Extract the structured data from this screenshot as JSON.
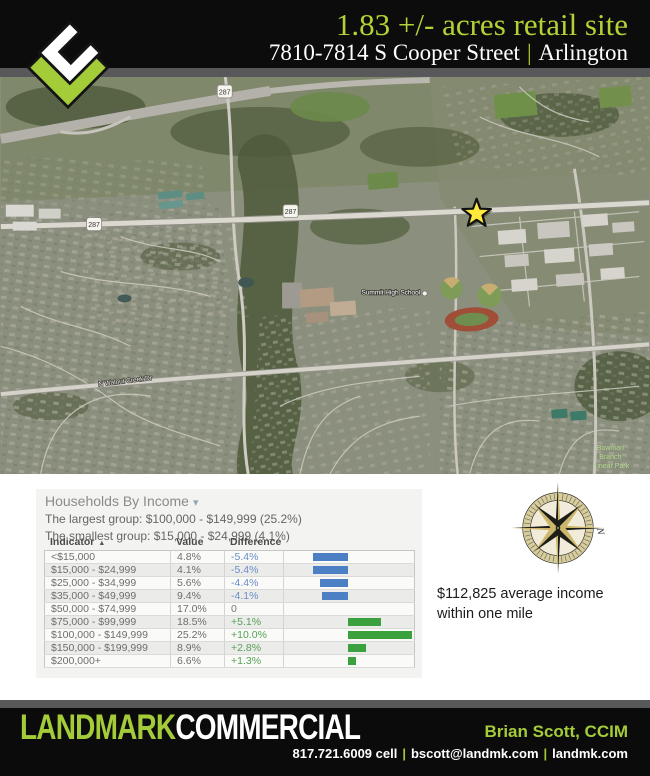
{
  "header": {
    "title": "1.83 +/- acres retail site",
    "address": "7810-7814 S Cooper Street",
    "separator": "|",
    "city": "Arlington"
  },
  "map": {
    "labels": {
      "route_shield": "287",
      "school": "Summit High School",
      "road": "N Walnut Creek Dr",
      "park_line1": "Bowman",
      "park_line2": "Branch",
      "park_line3": "Linear Park"
    }
  },
  "compass": {
    "north_label": "N"
  },
  "stats": {
    "average_income": "$112,825 average income within one mile"
  },
  "income_panel": {
    "title": "Households By Income",
    "caret_icon": "▾",
    "largest_group": "The largest group: $100,000 - $149,999 (25.2%)",
    "smallest_group": "The smallest group: $15,000 - $24,999 (4.1%)",
    "columns": {
      "indicator": "Indicator",
      "sort_icon": "▲",
      "value": "Value",
      "difference": "Difference"
    },
    "rows": [
      {
        "indicator": "<$15,000",
        "value": "4.8%",
        "difference": "-5.4%",
        "diff_value": -5.4
      },
      {
        "indicator": "$15,000 - $24,999",
        "value": "4.1%",
        "difference": "-5.4%",
        "diff_value": -5.4
      },
      {
        "indicator": "$25,000 - $34,999",
        "value": "5.6%",
        "difference": "-4.4%",
        "diff_value": -4.4
      },
      {
        "indicator": "$35,000 - $49,999",
        "value": "9.4%",
        "difference": "-4.1%",
        "diff_value": -4.1
      },
      {
        "indicator": "$50,000 - $74,999",
        "value": "17.0%",
        "difference": "0",
        "diff_value": 0
      },
      {
        "indicator": "$75,000 - $99,999",
        "value": "18.5%",
        "difference": "+5.1%",
        "diff_value": 5.1
      },
      {
        "indicator": "$100,000 - $149,999",
        "value": "25.2%",
        "difference": "+10.0%",
        "diff_value": 10.0
      },
      {
        "indicator": "$150,000 - $199,999",
        "value": "8.9%",
        "difference": "+2.8%",
        "diff_value": 2.8
      },
      {
        "indicator": "$200,000+",
        "value": "6.6%",
        "difference": "+1.3%",
        "diff_value": 1.3
      }
    ]
  },
  "chart_data": {
    "type": "bar",
    "title": "Households By Income",
    "categories": [
      "<$15,000",
      "$15,000 - $24,999",
      "$25,000 - $34,999",
      "$35,000 - $49,999",
      "$50,000 - $74,999",
      "$75,000 - $99,999",
      "$100,000 - $149,999",
      "$150,000 - $199,999",
      "$200,000+"
    ],
    "series": [
      {
        "name": "Value %",
        "values": [
          4.8,
          4.1,
          5.6,
          9.4,
          17.0,
          18.5,
          25.2,
          8.9,
          6.6
        ]
      },
      {
        "name": "Difference %",
        "values": [
          -5.4,
          -5.4,
          -4.4,
          -4.1,
          0,
          5.1,
          10.0,
          2.8,
          1.3
        ]
      }
    ],
    "xlabel": "Indicator",
    "ylabel": "Difference",
    "ylim": [
      -10,
      10
    ],
    "legend_position": "none",
    "grid": false,
    "note": "diverging horizontal bars; negative = blue, positive = green"
  },
  "footer": {
    "brand_first": "LANDMARK",
    "brand_second": "COMMERCIAL",
    "agent": "Brian Scott, CCIM",
    "phone": "817.721.6009 cell",
    "email": "bscott@landmk.com",
    "website": "landmk.com",
    "separator": "|"
  },
  "colors": {
    "accent_green": "#a4cc39",
    "bar_blue": "#4d7fc4",
    "bar_green": "#3aa13c",
    "star_yellow": "#ffe93c",
    "compass_tan": "#c9b468",
    "banner_black": "#0c0c0c"
  }
}
